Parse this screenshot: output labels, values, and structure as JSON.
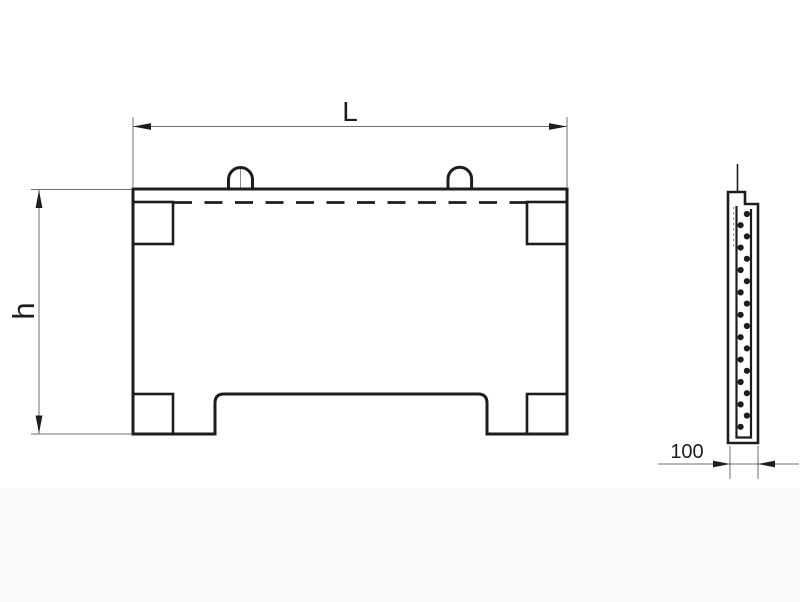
{
  "labels": {
    "length": "L",
    "height": "h",
    "thickness": "100"
  },
  "colors": {
    "line": "#1d1d1b",
    "thin_line": "#6f6f6f",
    "hidden_line": "#9a9a9a",
    "background": "#ffffff"
  },
  "front_view": {
    "lifting_loop_count": 2,
    "corner_block_count": 4
  },
  "side_view": {
    "rebar_dot_count": 20,
    "dot_radius": 3.1,
    "dot_y_start": 214,
    "dot_y_step": 11.2,
    "dot_x_left": 740.6,
    "dot_x_right": 746.9
  }
}
